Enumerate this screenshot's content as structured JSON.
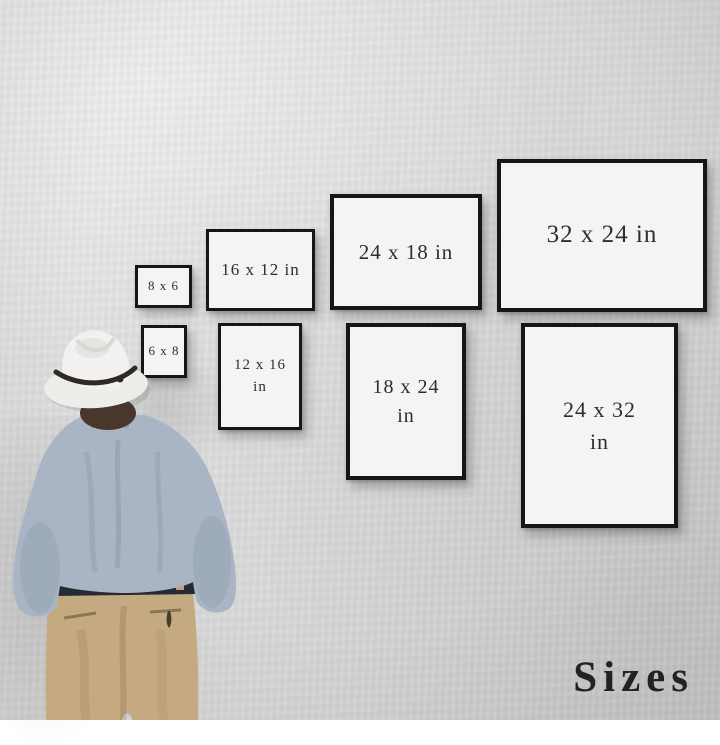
{
  "footer": {
    "label": "Sizes"
  },
  "frames": {
    "f8x6": {
      "label": "8 x 6"
    },
    "f16x12": {
      "label": "16 x 12 in"
    },
    "f24x18": {
      "label": "24 x 18 in"
    },
    "f32x24": {
      "label": "32 x 24 in"
    },
    "f6x8": {
      "label": "6 x 8"
    },
    "f12x16": {
      "line1": "12 x 16",
      "line2": "in"
    },
    "f18x24": {
      "line1": "18 x 24",
      "line2": "in"
    },
    "f24x32": {
      "line1": "24 x 32",
      "line2": "in"
    }
  },
  "colors": {
    "wall": "#dbdbdb",
    "frame_border": "#161616",
    "frame_paper": "#f5f4f2",
    "label_text": "#2e2e2e",
    "footer_text": "#222222",
    "hat": "#f1f0ee",
    "hat_band": "#2e2a26",
    "hair": "#4a372c",
    "shirt": "#a9b5c4",
    "pants": "#c5a980",
    "belt": "#262b33"
  }
}
